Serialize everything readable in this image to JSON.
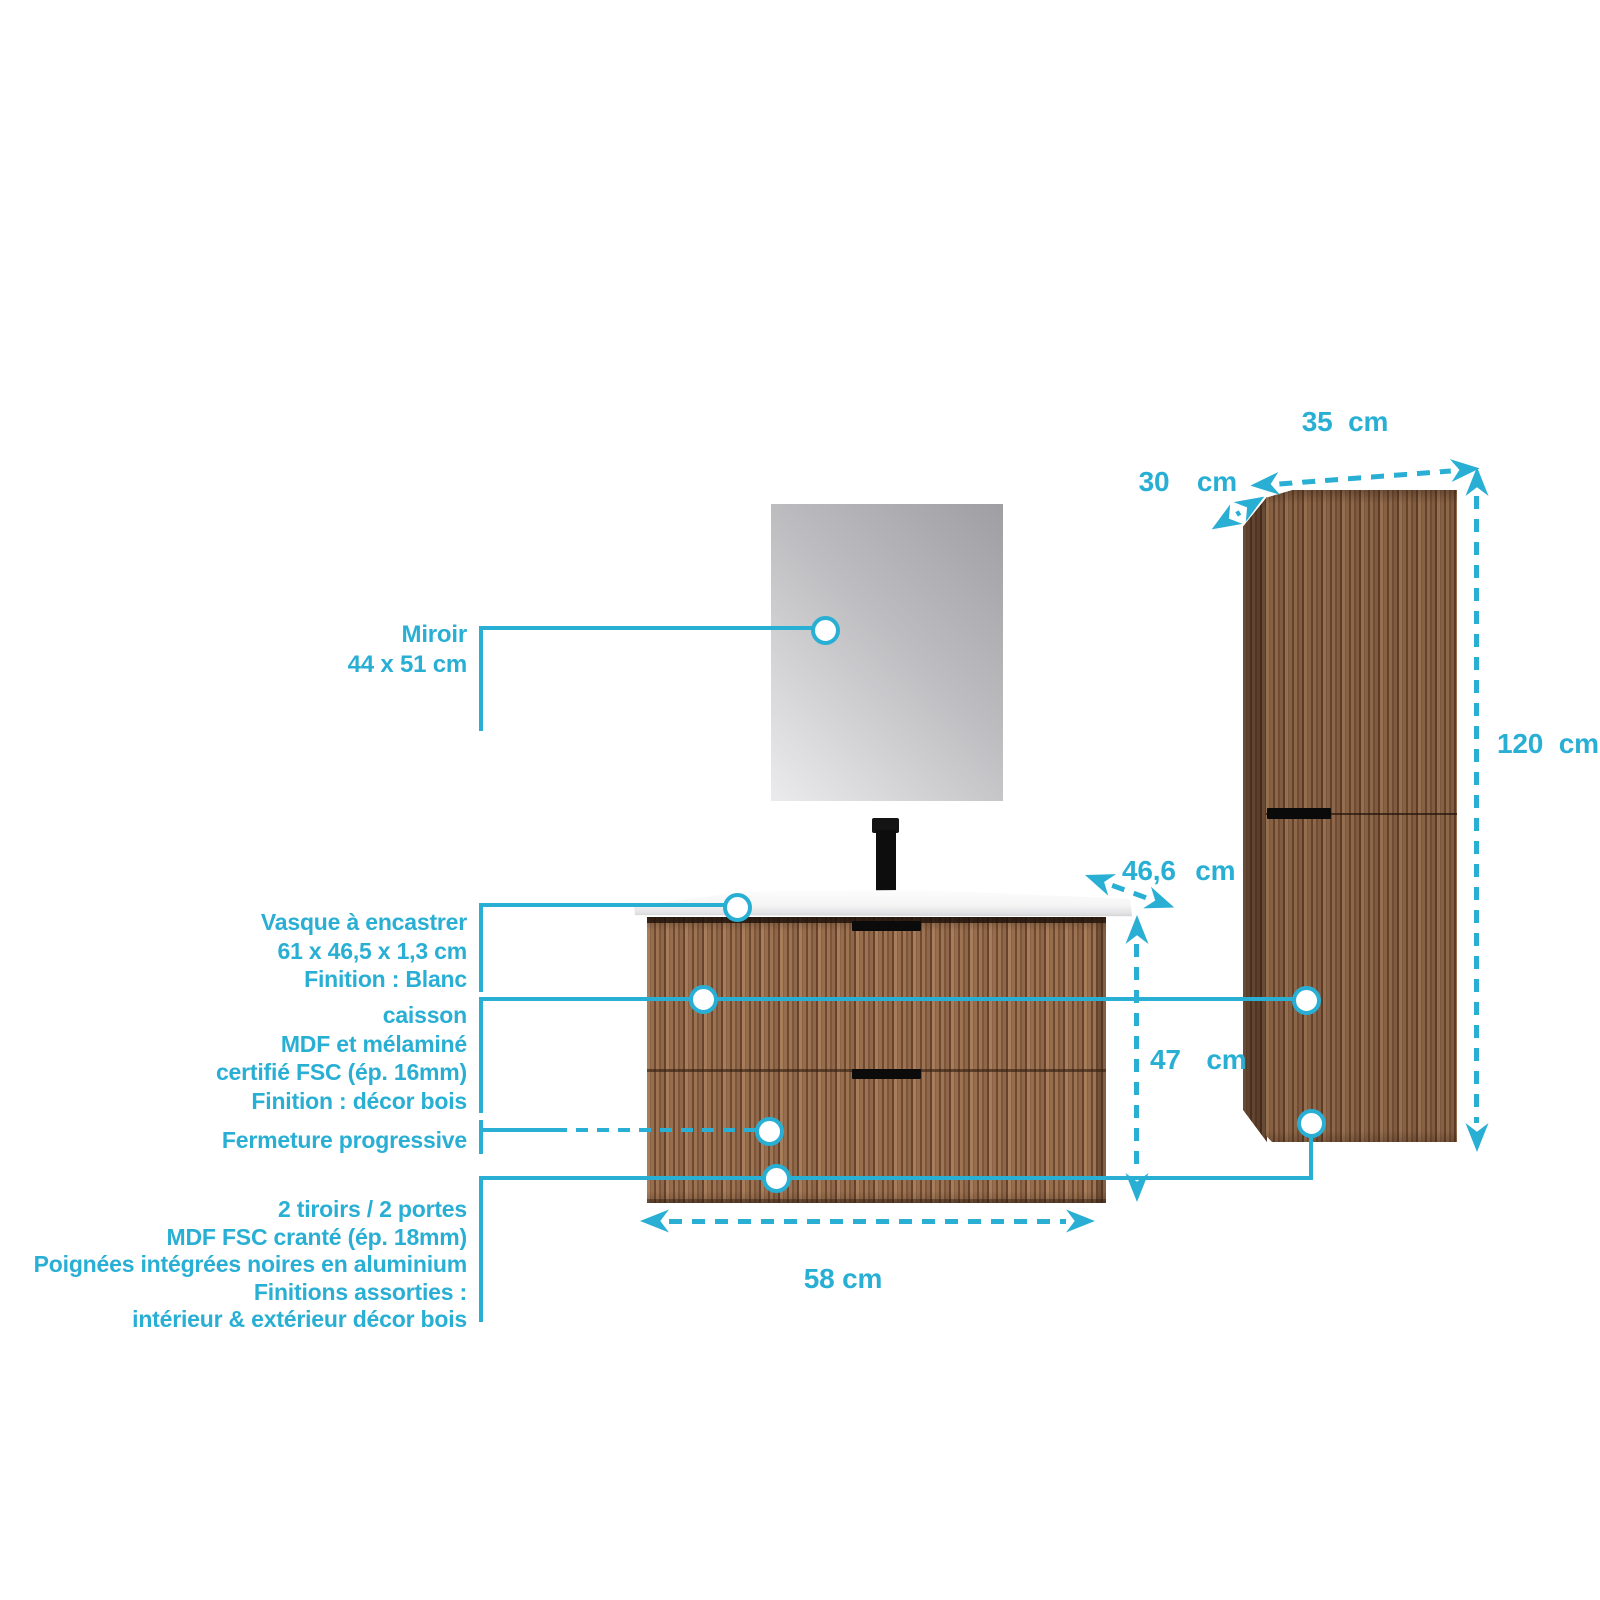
{
  "accent_color": "#29AFD4",
  "callouts": {
    "miroir": {
      "lines": [
        "Miroir",
        "44 x 51 cm"
      ]
    },
    "vasque": {
      "lines": [
        "Vasque à encastrer",
        "61 x 46,5 x 1,3 cm",
        "Finition : Blanc"
      ]
    },
    "caisson": {
      "lines": [
        "caisson",
        "MDF et mélaminé",
        "certifié FSC (ép. 16mm)",
        "Finition : décor bois"
      ]
    },
    "fermeture": {
      "lines": [
        "Fermeture progressive"
      ]
    },
    "tiroirs": {
      "lines": [
        "2 tiroirs / 2 portes",
        "MDF FSC cranté (ép. 18mm)",
        "Poignées intégrées noires en aluminium",
        "Finitions assorties :",
        "intérieur & extérieur décor bois"
      ]
    }
  },
  "dimensions": {
    "column_width": "35 cm",
    "column_depth": "30 cm",
    "column_height": "120 cm",
    "vanity_depth": "46,6 cm",
    "vanity_height": "47 cm",
    "vanity_width": "58 cm"
  }
}
